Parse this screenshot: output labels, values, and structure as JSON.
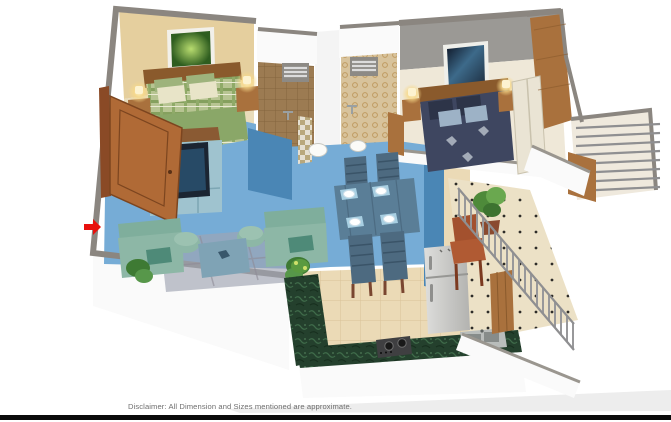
{
  "window": {
    "width": 671,
    "height": 422,
    "background": "#ffffff"
  },
  "footer": {
    "disclaimer": "Disclaimer: All Dimension and Sizes mentioned are approximate.",
    "text_color": "#6f6f6f",
    "bar_color": "#0b0b0b"
  },
  "annotations": {
    "entrance_arrow": {
      "icon": "red-arrow-right",
      "color": "#e8100c"
    }
  },
  "palette": {
    "highlight_blue": "#76acd6",
    "highlight_wall_blue": "#4a86b5",
    "wall_cap_gray": "#8b8680",
    "wood_brown": "#a9713d",
    "granite_green": "#24402d",
    "fridge_silver": "#c9cac7",
    "railing_gray": "#8f8f91",
    "bed1_plaid_green": "#b7c492",
    "bed2_navy": "#3e4660",
    "sofa_teal": "#8db7a6"
  },
  "rooms": [
    {
      "name": "master-bedroom",
      "wall": "#e5cf9e",
      "floor": "#e9dcba",
      "highlighted": false
    },
    {
      "name": "bathroom-1",
      "floor": "#9c7b52",
      "highlighted": false
    },
    {
      "name": "bathroom-2",
      "floor": "#d8c39c",
      "highlighted": false
    },
    {
      "name": "bedroom-2",
      "wall": "#9b9995",
      "floor": "#efe8d8",
      "highlighted": false
    },
    {
      "name": "living-room",
      "floor": "#76acd6",
      "highlighted": true
    },
    {
      "name": "dining-area",
      "floor": "#76acd6",
      "highlighted": true
    },
    {
      "name": "kitchen",
      "floor": "#ebdab6",
      "highlighted": false
    },
    {
      "name": "utility-balcony",
      "floor": "#ece1c6",
      "highlighted": false
    },
    {
      "name": "bedroom-balcony",
      "floor": "#efe9dd",
      "highlighted": false
    }
  ]
}
